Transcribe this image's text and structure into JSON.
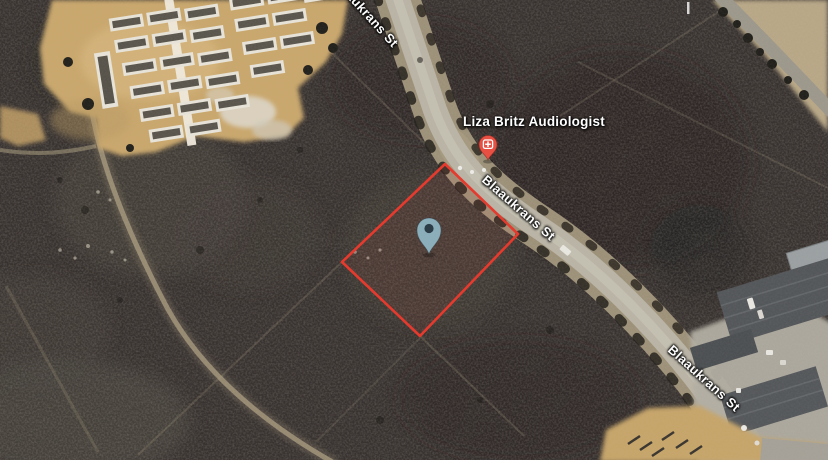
{
  "map": {
    "view_type": "satellite",
    "poi": {
      "label": "Liza Britz Audiologist",
      "category": "health",
      "pin_color": "#e85043"
    },
    "streets": {
      "top": {
        "text": "Blaaukrans St"
      },
      "mid": {
        "text": "Blaaukrans St"
      },
      "bottom": {
        "text": "Blaaukrans St"
      }
    },
    "parcel": {
      "outline_color": "#e53a2e"
    },
    "marker": {
      "fill": "#8fb5c2",
      "hole_color": "#2b3c46"
    }
  }
}
